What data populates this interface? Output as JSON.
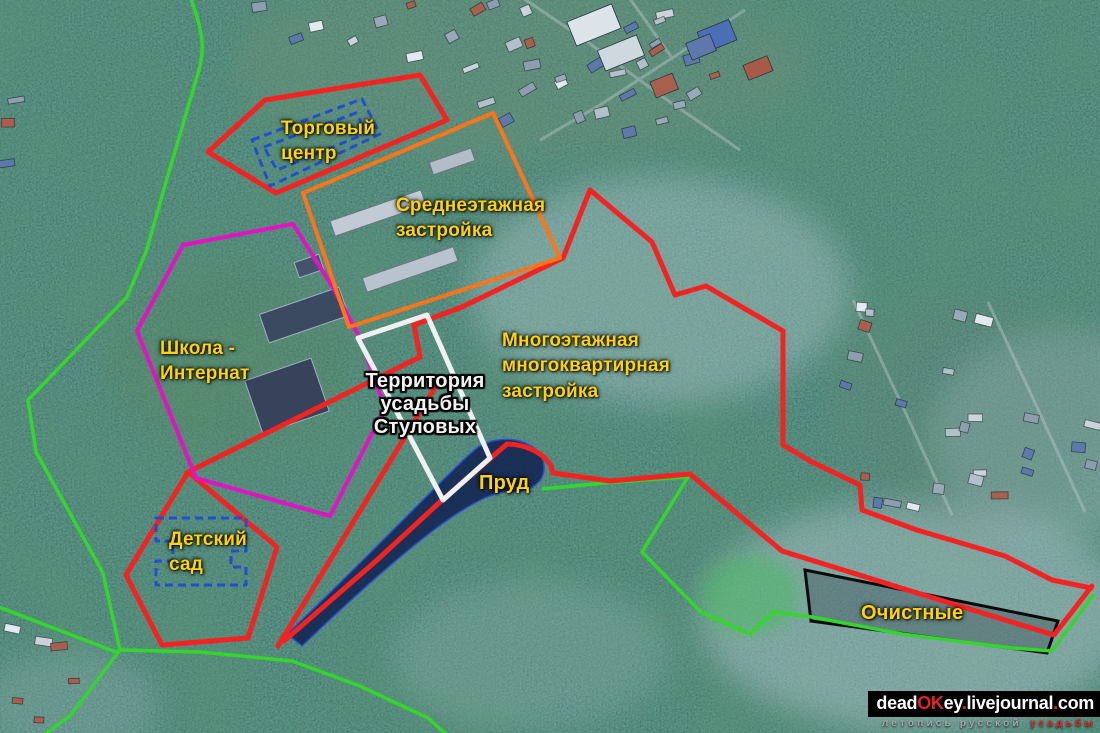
{
  "map": {
    "palette": {
      "greenbelt": "#33d62a",
      "red_zone": "#f52222",
      "orange_zone": "#ff7416",
      "school_zone": "#e312c4",
      "estate_outline": "#f0f0f0",
      "blue_dashed": "#1e49d8",
      "treatment_outline": "#0b0b0b",
      "pond_fill": "#0e1c4e",
      "pond_stroke": "#2a4fd0",
      "label_yellow": "#ffd400",
      "estate_label": "#f3f3f3"
    },
    "zones": {
      "shopping_center": {
        "label": "Торговый\nцентр"
      },
      "midrise": {
        "label": "Среднеэтажная\nзастройка"
      },
      "school": {
        "label": "Школа -\nИнтернат"
      },
      "estate": {
        "label": "Территория\nусадьбы\nСтуловых"
      },
      "multistorey": {
        "label": "Многоэтажная\nмногоквартирная\nзастройка"
      },
      "pond": {
        "label": "Пруд"
      },
      "kindergarten": {
        "label": "Детский\nсад"
      },
      "treatment": {
        "label": "Очистные"
      }
    },
    "watermark": {
      "parts": [
        {
          "t": "dead"
        },
        {
          "t": "OK"
        },
        {
          "t": "ey"
        },
        {
          "t": "."
        },
        {
          "t": "livejournal"
        },
        {
          "t": "."
        },
        {
          "t": "com"
        }
      ],
      "tagline": {
        "t1": "летопись русской",
        "t2": "усадьбы"
      }
    }
  }
}
